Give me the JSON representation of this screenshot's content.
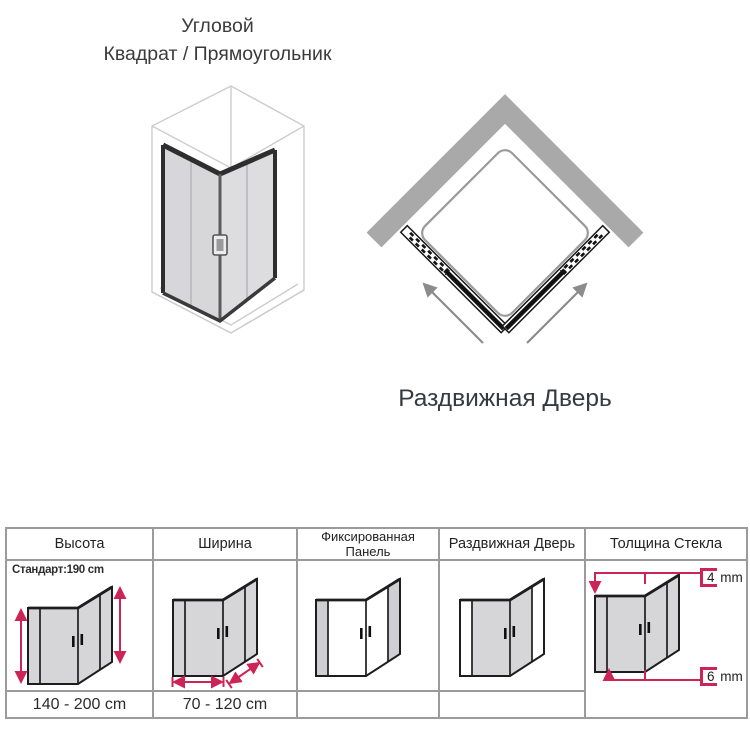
{
  "title": {
    "line1": "Угловой",
    "line2": "Квадрат / Прямоугольник"
  },
  "top_view": {
    "caption": "Раздвижная Дверь",
    "wall_icon": "corner-wall",
    "tray_icon": "shower-tray",
    "track_icons": [
      "left-door-track",
      "right-door-track"
    ],
    "arrow_icons": [
      "slide-arrow-left",
      "slide-arrow-right"
    ]
  },
  "iso_drawing": "corner-shower-enclosure-isometric",
  "colors": {
    "accent_red": "#cc2456",
    "wall_gray": "#a9a9a9",
    "glass_gray": "#d6d6d9",
    "frame_dark": "#1d1d1d",
    "table_border_gray": "#9b9b9b",
    "text_dark": "#2e2e2e"
  },
  "table": {
    "headers": [
      "Высота",
      "Ширина",
      "Фиксированная Панель",
      "Раздвижная Дверь",
      "Толщина Стекла"
    ],
    "height_col": {
      "standard": "Стандарт:190 cm",
      "range": "140 - 200 cm"
    },
    "width_col": {
      "range": "70 - 120 cm"
    },
    "fixed_panel_col": {
      "range": ""
    },
    "sliding_door_col": {
      "range": ""
    },
    "glass_col": {
      "thin_value": "4",
      "thick_value": "6",
      "unit": "mm"
    }
  }
}
